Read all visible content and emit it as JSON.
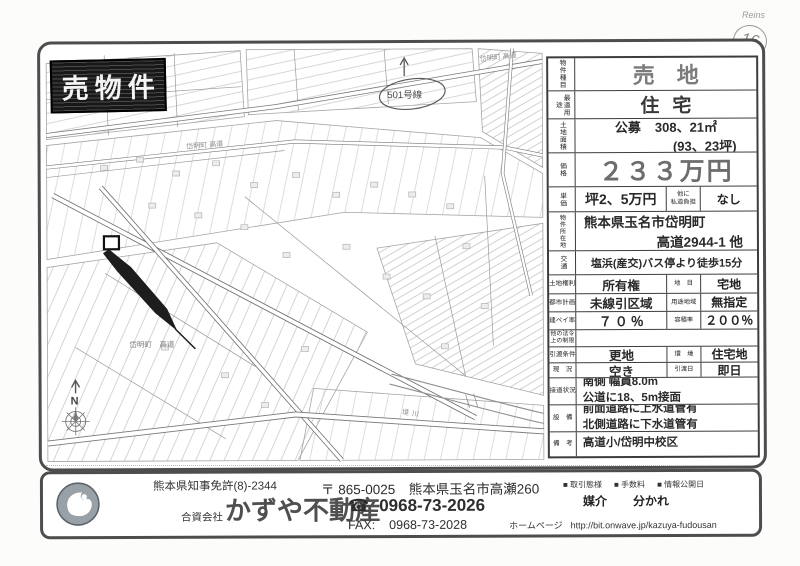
{
  "page": {
    "handwritten_reins": "Reins",
    "handwritten_number": "16"
  },
  "stamp": {
    "text": "売物件"
  },
  "map": {
    "label_top": "岱明町 高道",
    "label_mid": "岱明町 高道",
    "label_bottom": "岱明町　高道",
    "river": "境川",
    "north": "N",
    "route_note": "501号線"
  },
  "listing": {
    "property_type": {
      "label": "物件種目",
      "value": "売地"
    },
    "best_use": {
      "label": "最適用途",
      "value": "住宅"
    },
    "land_area": {
      "label": "土地面積",
      "prefix": "公募",
      "value": "308、21㎡",
      "value2": "(93、23坪)"
    },
    "price": {
      "label": "価格",
      "value": "２３３万円"
    },
    "unit_price": {
      "label": "単価",
      "value": "坪2、5万円",
      "sub_label1": "他に",
      "sub_label2": "私道負担",
      "sub_value": "なし"
    },
    "location": {
      "label": "物件所在地",
      "line1": "熊本県玉名市岱明町",
      "line2": "高道2944-1 他"
    },
    "transport": {
      "label": "交通",
      "value": "塩浜(産交)バス停より徒歩15分"
    },
    "land_rights": {
      "label": "土地権利",
      "value": "所有権",
      "sub_label": "地　目",
      "sub_value": "宅地"
    },
    "city_planning": {
      "label": "都市計画",
      "value": "未線引区域",
      "sub_label": "用途地域",
      "sub_value": "無指定"
    },
    "coverage_ratio": {
      "label": "建ペイ率",
      "value": "７０％",
      "sub_label": "容積率",
      "sub_value": "２００％"
    },
    "other_laws": {
      "label1": "他の法令",
      "label2": "上の制限",
      "value": ""
    },
    "handover": {
      "label": "引渡条件",
      "value": "更地",
      "sub_label": "環　境",
      "sub_value": "住宅地"
    },
    "current_status": {
      "label": "現　況",
      "value": "空き",
      "sub_label": "引渡日",
      "sub_value": "即日"
    },
    "road_access": {
      "label": "接道状況",
      "line1": "南側 幅員8.0m",
      "line2": "公道に18、5m接面"
    },
    "facilities": {
      "label": "設　備",
      "line1": "前面道路に上水道管有",
      "line2": "北側道路に下水道管有"
    },
    "remarks": {
      "label": "備　考",
      "value": "高道小/岱明中校区"
    }
  },
  "company": {
    "license": "熊本県知事免許(8)-2344",
    "entity_type": "合資会社",
    "name": "かずや不動産",
    "postal": "〒 865-0025　熊本県玉名市高瀬260",
    "tel_icon": "☎",
    "tel": "0968-73-2026",
    "fax_label": "FAX:",
    "fax": "0968-73-2028",
    "deal_label": "■ 取引態様",
    "deal_value": "媒介",
    "fee_label": "■ 手数料",
    "fee_value": "分かれ",
    "disclosure_label": "■ 情報公開日",
    "homepage_label": "ホームページ",
    "homepage_url": "http://bit.onwave.jp/kazuya-fudousan"
  }
}
